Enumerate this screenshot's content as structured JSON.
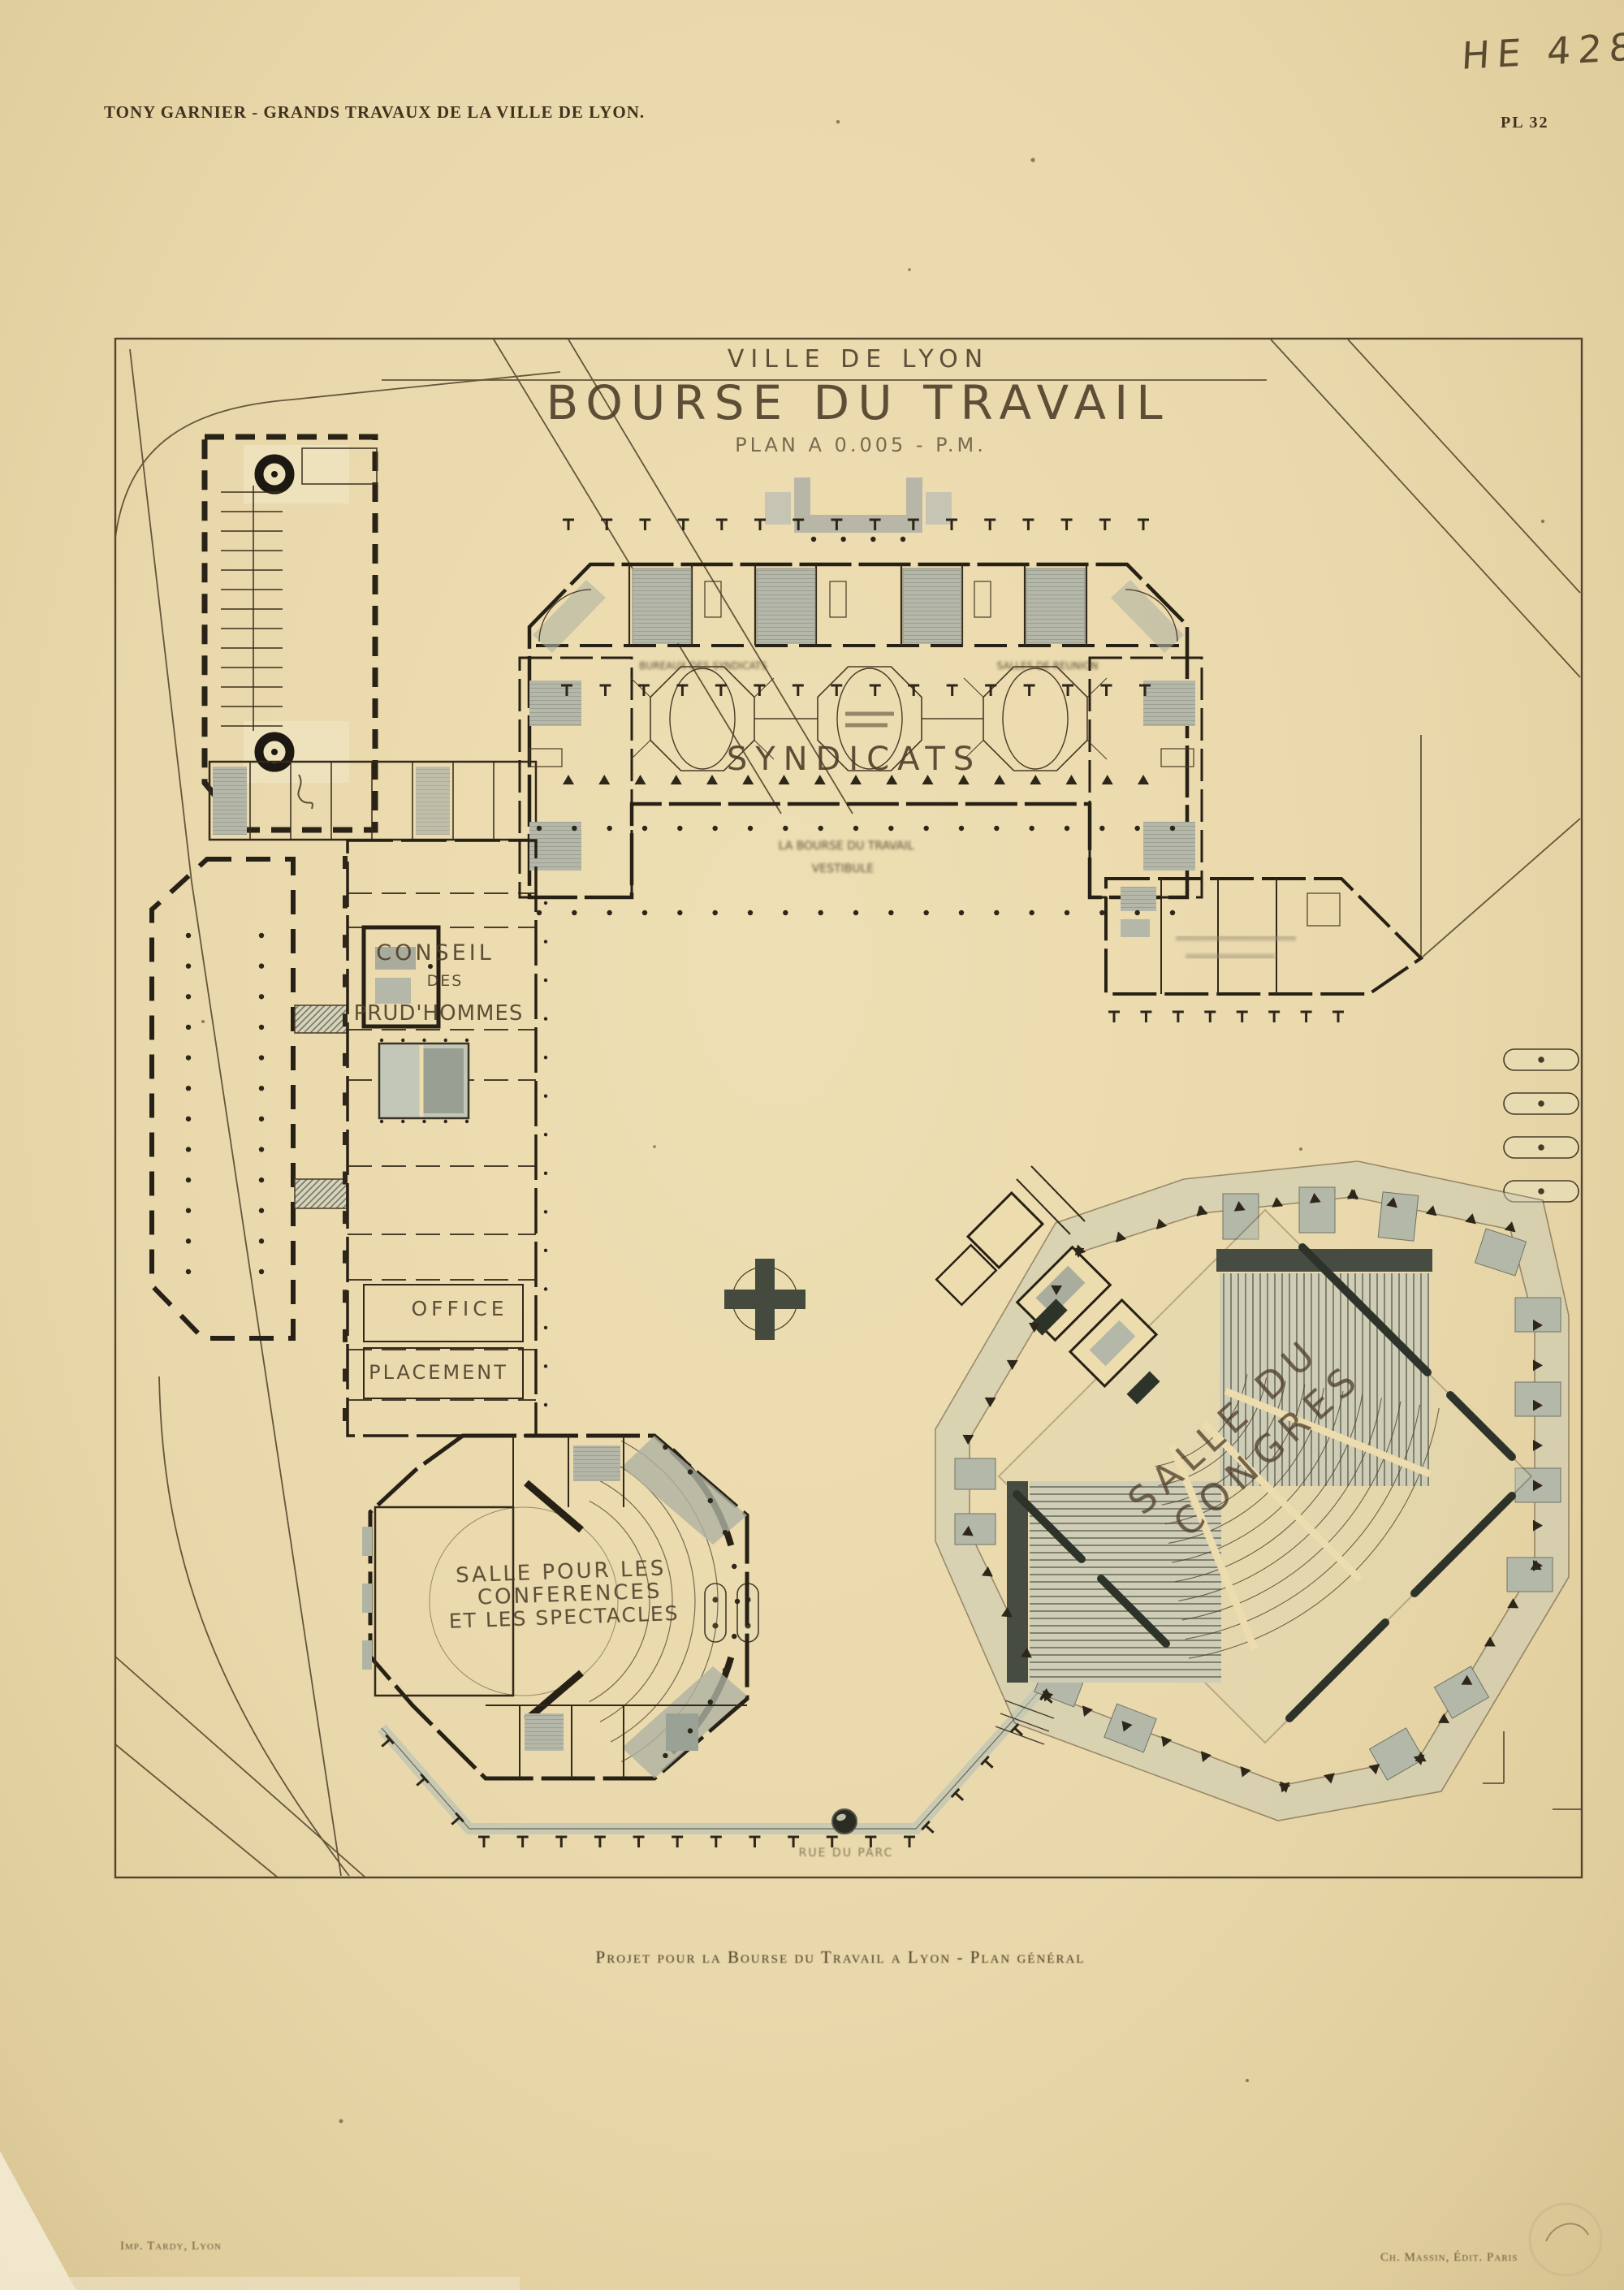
{
  "page": {
    "header_left": "TONY GARNIER - GRANDS TRAVAUX DE LA VILLE DE LYON.",
    "plate_number": "PL 32",
    "inventory_number": "HE 428",
    "caption": "Projet pour la Bourse du Travail a Lyon - Plan général",
    "credit_left": "Imp. Tardy, Lyon",
    "credit_right": "Ch. Massin, Édit. Paris"
  },
  "plan": {
    "title": {
      "line1": "VILLE DE LYON",
      "line2": "BOURSE DU TRAVAIL",
      "line3": "PLAN A 0.005 - P.M."
    },
    "labels": {
      "syndicats": "SYNDICATS",
      "conseil1": "CONSEIL",
      "conseil2": "DES",
      "conseil3": "PRUD'HOMMES",
      "office": "OFFICE",
      "placement": "PLACEMENT",
      "conf1": "SALLE POUR LES",
      "conf2": "CONFERENCES",
      "conf3": "ET LES SPECTACLES",
      "congres1": "SALLE DU",
      "congres2": "CONGRES",
      "street": "RUE DU PARC",
      "stamp1": "LA BOURSE DU TRAVAIL",
      "stamp2": "VESTIBULE",
      "caption_rooms_left": "BUREAUX DES SYNDICATS",
      "caption_rooms_right": "SALLES DE REUNION"
    },
    "colors": {
      "paper": "#ecdcae",
      "ink": "#4a3b27",
      "wall": "#272115",
      "wash": "#b5b7a8",
      "wash_dark": "#474c42"
    }
  }
}
